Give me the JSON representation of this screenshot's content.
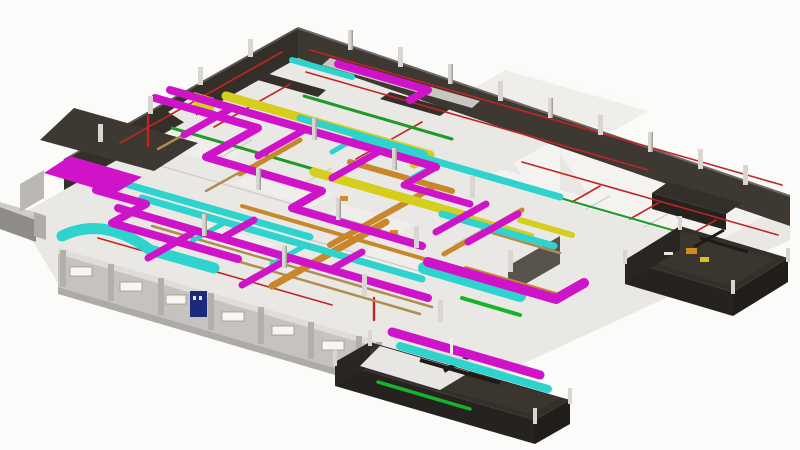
{
  "scene": {
    "background": "#fbfbfa",
    "floor": "#eae8e5",
    "floor_bright": "#f4f3f0",
    "floor_white_patch": "#f0eeeb",
    "slab_edge": "#aeaba7"
  },
  "walls": {
    "dark": "#352f2a",
    "dark_inner": "#3e3832",
    "dark_room_face": "#262220",
    "dark_room_floor": "#3b3530",
    "gray": "#59534d",
    "light": "#c6c3bf",
    "light_cap": "#e0ddd9",
    "gusset": "#e9e7e3",
    "corridor_band": "#c9c6c2"
  },
  "structure": {
    "column": "#d9d6d1",
    "column_shade": "#a39f9a",
    "partition_line": "#cdcac6"
  },
  "mep": {
    "duct_supply": "#cf13c9",
    "duct_return": "#2ed3ce",
    "duct_exhaust": "#d6ce1d",
    "pipe_mech": "#c8872a",
    "pipe_copper": "#b08d4f",
    "pipe_conduit": "#1d9a28",
    "pipe_conduit_bright": "#17b32c",
    "pipe_sprinkler": "#bf2623"
  },
  "openings": {
    "door_blue": "#1c2a7d",
    "window_fill": "#f7f6f4",
    "window_frame": "#9a978f"
  },
  "equipment": {
    "orange": "#cf8d1f",
    "yellow": "#d4c11c",
    "snout_top": "#cfccc8",
    "snout_side": "#8f8c88",
    "snout_flange": "#b0ada9"
  }
}
